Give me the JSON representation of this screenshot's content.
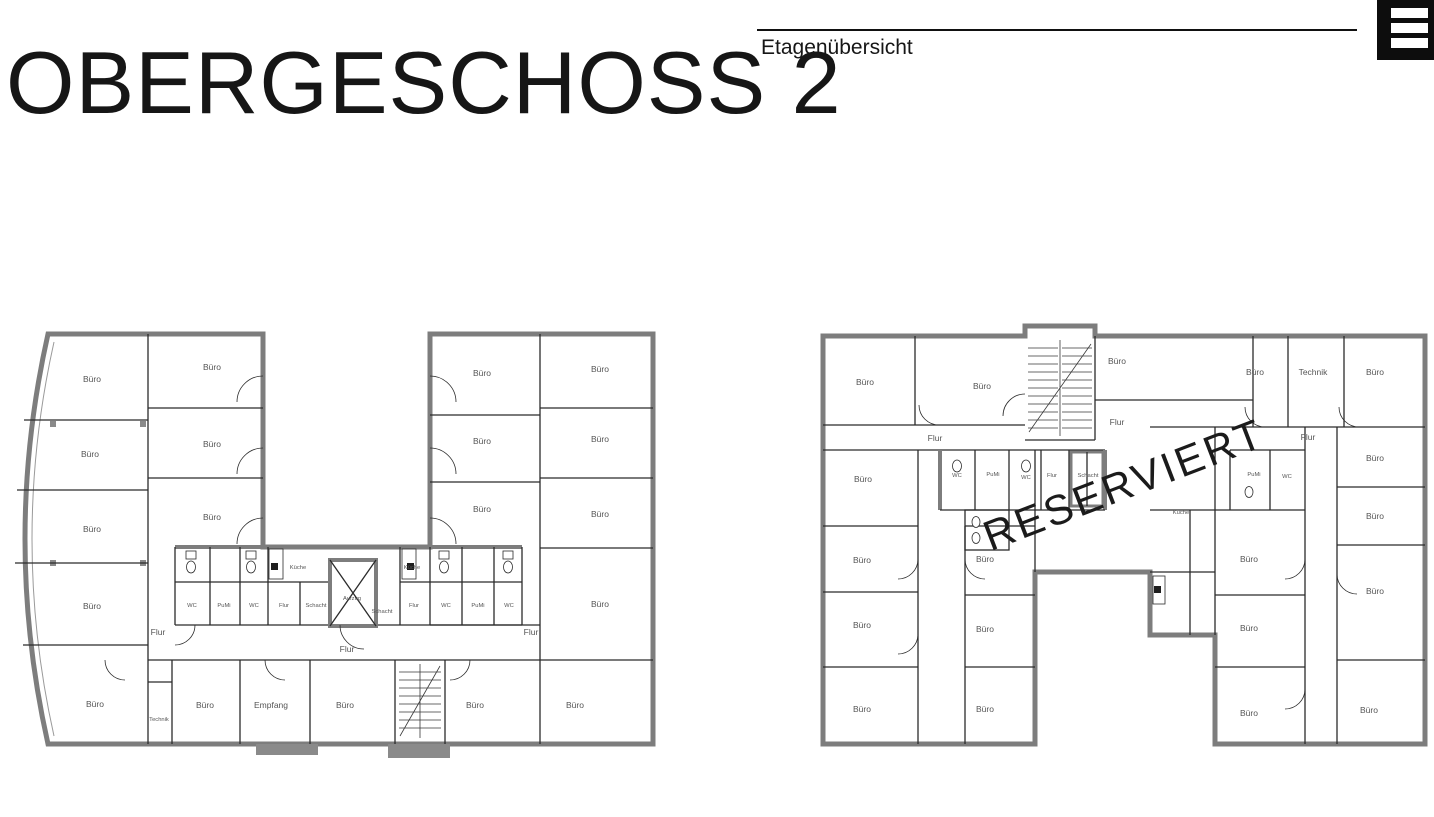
{
  "header": {
    "title": "OBERGESCHOSS 2",
    "subtitle": "Etagenübersicht"
  },
  "plans": [
    {
      "id": "left-building",
      "labels": [
        [
          "Büro",
          82,
          62
        ],
        [
          "Büro",
          80,
          137
        ],
        [
          "Büro",
          82,
          212
        ],
        [
          "Büro",
          82,
          289
        ],
        [
          "Büro",
          85,
          387
        ],
        [
          "Büro",
          202,
          50
        ],
        [
          "Büro",
          202,
          127
        ],
        [
          "Büro",
          202,
          200
        ],
        [
          "WC",
          182,
          287,
          "s"
        ],
        [
          "PuMi",
          214,
          287,
          "s"
        ],
        [
          "WC",
          244,
          287,
          "s"
        ],
        [
          "Flur",
          274,
          287,
          "s"
        ],
        [
          "Küche",
          288,
          249,
          "s"
        ],
        [
          "Schacht",
          306,
          287,
          "s"
        ],
        [
          "Aufzug",
          342,
          280,
          "s"
        ],
        [
          "Schacht",
          372,
          293,
          "s"
        ],
        [
          "Küche",
          402,
          249,
          "s"
        ],
        [
          "Flur",
          404,
          287,
          "s"
        ],
        [
          "WC",
          436,
          287,
          "s"
        ],
        [
          "PuMi",
          468,
          287,
          "s"
        ],
        [
          "WC",
          499,
          287,
          "s"
        ],
        [
          "Flur",
          148,
          315
        ],
        [
          "Flur",
          337,
          332
        ],
        [
          "Flur",
          521,
          315
        ],
        [
          "Technik",
          149,
          401,
          "s"
        ],
        [
          "Büro",
          195,
          388
        ],
        [
          "Empfang",
          261,
          388
        ],
        [
          "Büro",
          335,
          388
        ],
        [
          "Büro",
          465,
          388
        ],
        [
          "Büro",
          565,
          388
        ],
        [
          "Büro",
          472,
          56
        ],
        [
          "Büro",
          472,
          124
        ],
        [
          "Büro",
          472,
          192
        ],
        [
          "Büro",
          590,
          52
        ],
        [
          "Büro",
          590,
          122
        ],
        [
          "Büro",
          590,
          197
        ],
        [
          "Büro",
          590,
          287
        ]
      ]
    },
    {
      "id": "right-building",
      "labels": [
        [
          "Büro",
          46,
          61
        ],
        [
          "Büro",
          163,
          65
        ],
        [
          "Büro",
          298,
          40
        ],
        [
          "Flur",
          298,
          101
        ],
        [
          "Büro",
          436,
          51
        ],
        [
          "Technik",
          494,
          51
        ],
        [
          "Büro",
          556,
          51
        ],
        [
          "Flur",
          116,
          117
        ],
        [
          "Flur",
          489,
          116
        ],
        [
          "Büro",
          44,
          158
        ],
        [
          "Büro",
          43,
          239
        ],
        [
          "Büro",
          43,
          304
        ],
        [
          "Büro",
          43,
          388
        ],
        [
          "Büro",
          166,
          238
        ],
        [
          "Büro",
          166,
          308
        ],
        [
          "Büro",
          166,
          388
        ],
        [
          "WC",
          138,
          153,
          "s"
        ],
        [
          "PuMi",
          174,
          152,
          "s"
        ],
        [
          "WC",
          207,
          155,
          "s"
        ],
        [
          "Flur",
          233,
          153,
          "s"
        ],
        [
          "Schacht",
          269,
          153,
          "s"
        ],
        [
          "Küche",
          362,
          190,
          "s"
        ],
        [
          "PuMi",
          435,
          152,
          "s"
        ],
        [
          "WC",
          468,
          154,
          "s"
        ],
        [
          "Büro",
          556,
          137
        ],
        [
          "Büro",
          556,
          195
        ],
        [
          "Büro",
          556,
          270
        ],
        [
          "Büro",
          550,
          389
        ],
        [
          "Büro",
          430,
          238
        ],
        [
          "Büro",
          430,
          307
        ],
        [
          "Büro",
          430,
          392
        ]
      ],
      "watermark": {
        "text": "RESERVIERT"
      }
    }
  ]
}
